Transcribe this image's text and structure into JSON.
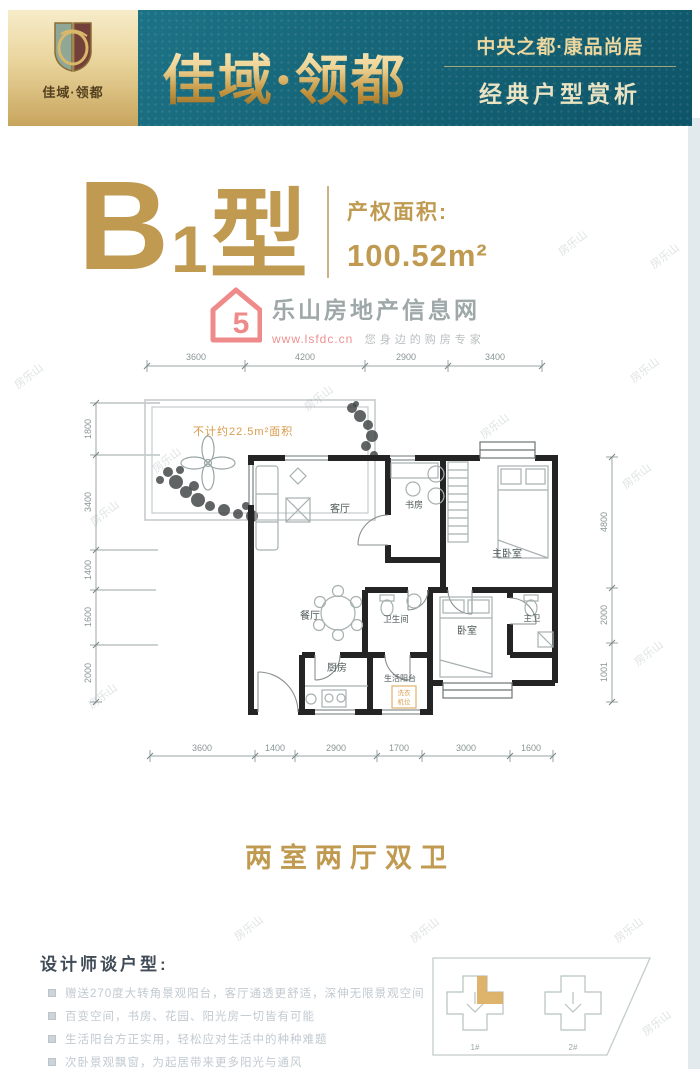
{
  "header": {
    "logo_text": "佳域·领都",
    "brand_large": "佳域·领都",
    "tagline_top": "中央之都·康品尚居",
    "tagline_bottom": "经典户型赏析"
  },
  "unit": {
    "type_main": "B",
    "type_sub": "1",
    "type_suffix": "型",
    "area_label": "产权面积:",
    "area_value": "100.52m²"
  },
  "site_mark": {
    "logo_glyph": "5",
    "site_name": "乐山房地产信息网",
    "site_url": "www.lsfdc.cn",
    "site_slogan": "您身边的购房专家"
  },
  "floorplan": {
    "note": "不计约22.5m²面积",
    "rooms": {
      "living": "客厅",
      "dining": "餐厅",
      "kitchen": "厨房",
      "study": "书房",
      "master_bedroom": "主卧室",
      "bedroom": "卧室",
      "bathroom": "卫生间",
      "master_bath": "主卫",
      "service_balcony": "生活阳台",
      "washer1": "洗衣",
      "washer2": "机位"
    },
    "dims_top": [
      "3600",
      "4200",
      "2900",
      "3400"
    ],
    "dims_bottom": [
      "3600",
      "1400",
      "2900",
      "1700",
      "3000",
      "1600"
    ],
    "dims_left": [
      "1800",
      "3400",
      "1400",
      "1600",
      "2000"
    ],
    "dims_right": [
      "4800",
      "2000",
      "1001"
    ]
  },
  "summary": {
    "layout_title": "两室两厅双卫"
  },
  "designer": {
    "heading": "设计师谈户型:",
    "points": [
      "赠送270度大转角景观阳台，客厅通透更舒适，深伸无限景观空间",
      "百变空间，书房、花园、阳光房一切皆有可能",
      "生活阳台方正实用，轻松应对生活中的种种难题",
      "次卧景观飘窗，为起居带来更多阳光与通风"
    ]
  },
  "siteplan": {
    "building1": "1#",
    "building2": "2#"
  },
  "page_watermark": "房乐山",
  "colors": {
    "gold": "#bf9a50",
    "teal": "#166275",
    "logo_red": "#ef8a8a",
    "wall": "#242424",
    "dim_text": "#8a9595",
    "orange_note": "#d99a4a"
  }
}
